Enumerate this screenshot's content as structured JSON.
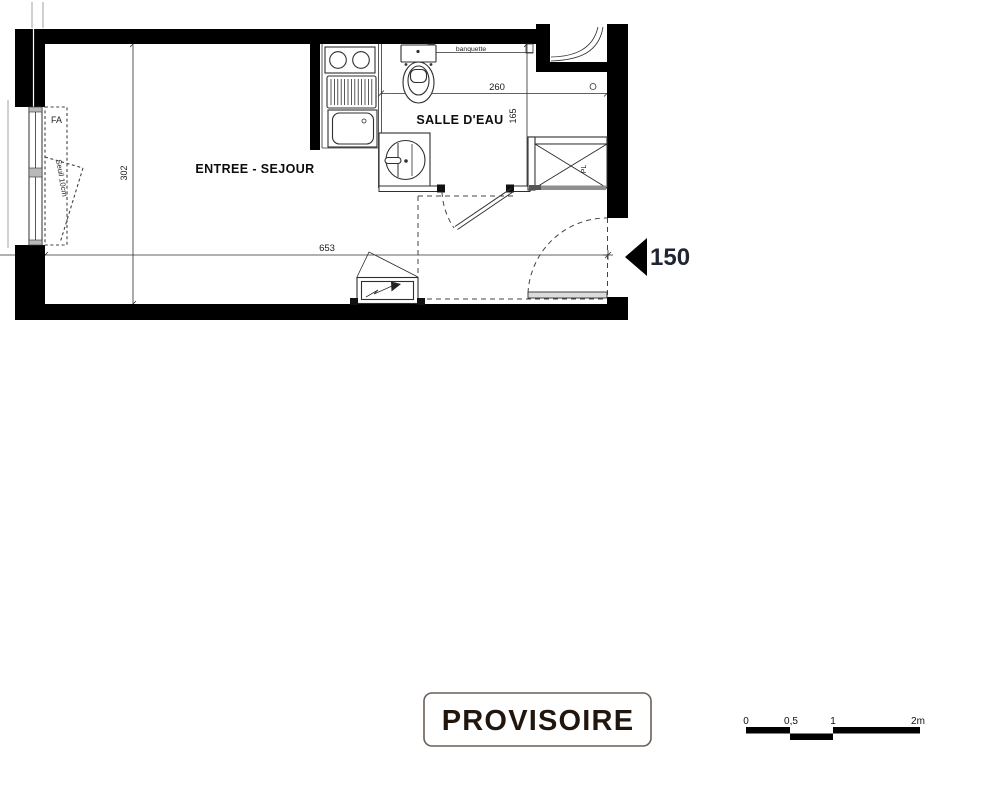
{
  "colors": {
    "wall": "#000000",
    "line": "#2f2f2f",
    "dashed": "#444444",
    "text": "#101010",
    "stamp_border": "#6a5f58",
    "stamp_text": "#20160e",
    "arrow_label": "#1f2633"
  },
  "plan": {
    "rooms": [
      {
        "id": "entree-sejour",
        "label": "ENTREE - SEJOUR"
      },
      {
        "id": "salle-deau",
        "label": "SALLE D'EAU"
      }
    ],
    "annotations": {
      "fa": "FA",
      "seuil": "Seuil 10cm",
      "banquette": "banquette",
      "placard": "PL",
      "entry_width": "150"
    },
    "dimensions": {
      "living_width": "653",
      "living_depth": "302",
      "bath_width": "260",
      "bath_depth": "165"
    }
  },
  "stamp": {
    "label": "PROVISOIRE"
  },
  "scale_bar": {
    "labels": [
      "0",
      "0,5",
      "1",
      "2m"
    ]
  }
}
